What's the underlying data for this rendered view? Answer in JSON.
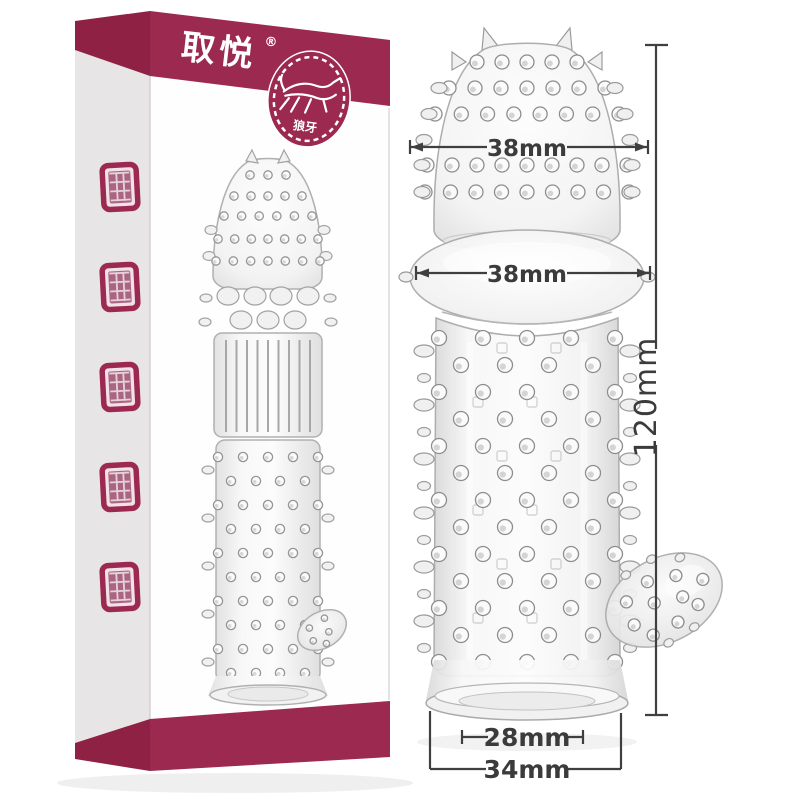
{
  "brand": {
    "name": "取悦",
    "registered_mark": "®"
  },
  "badge": {
    "label": "狼牙"
  },
  "box": {
    "bottom_banner": "狼牙刺套(战栗)",
    "seal_stamp_count": 5
  },
  "measurements": {
    "head_diameter": "38mm",
    "bulb_diameter": "38mm",
    "length": "120mm",
    "base_inner_diameter": "28mm",
    "base_outer_diameter": "34mm"
  },
  "colors": {
    "brand_maroon": "#9c2950",
    "band_shadow_maroon": "#8e2144",
    "box_side_gray": "#e7e5e6",
    "dimension_line": "#3f3f3f"
  }
}
